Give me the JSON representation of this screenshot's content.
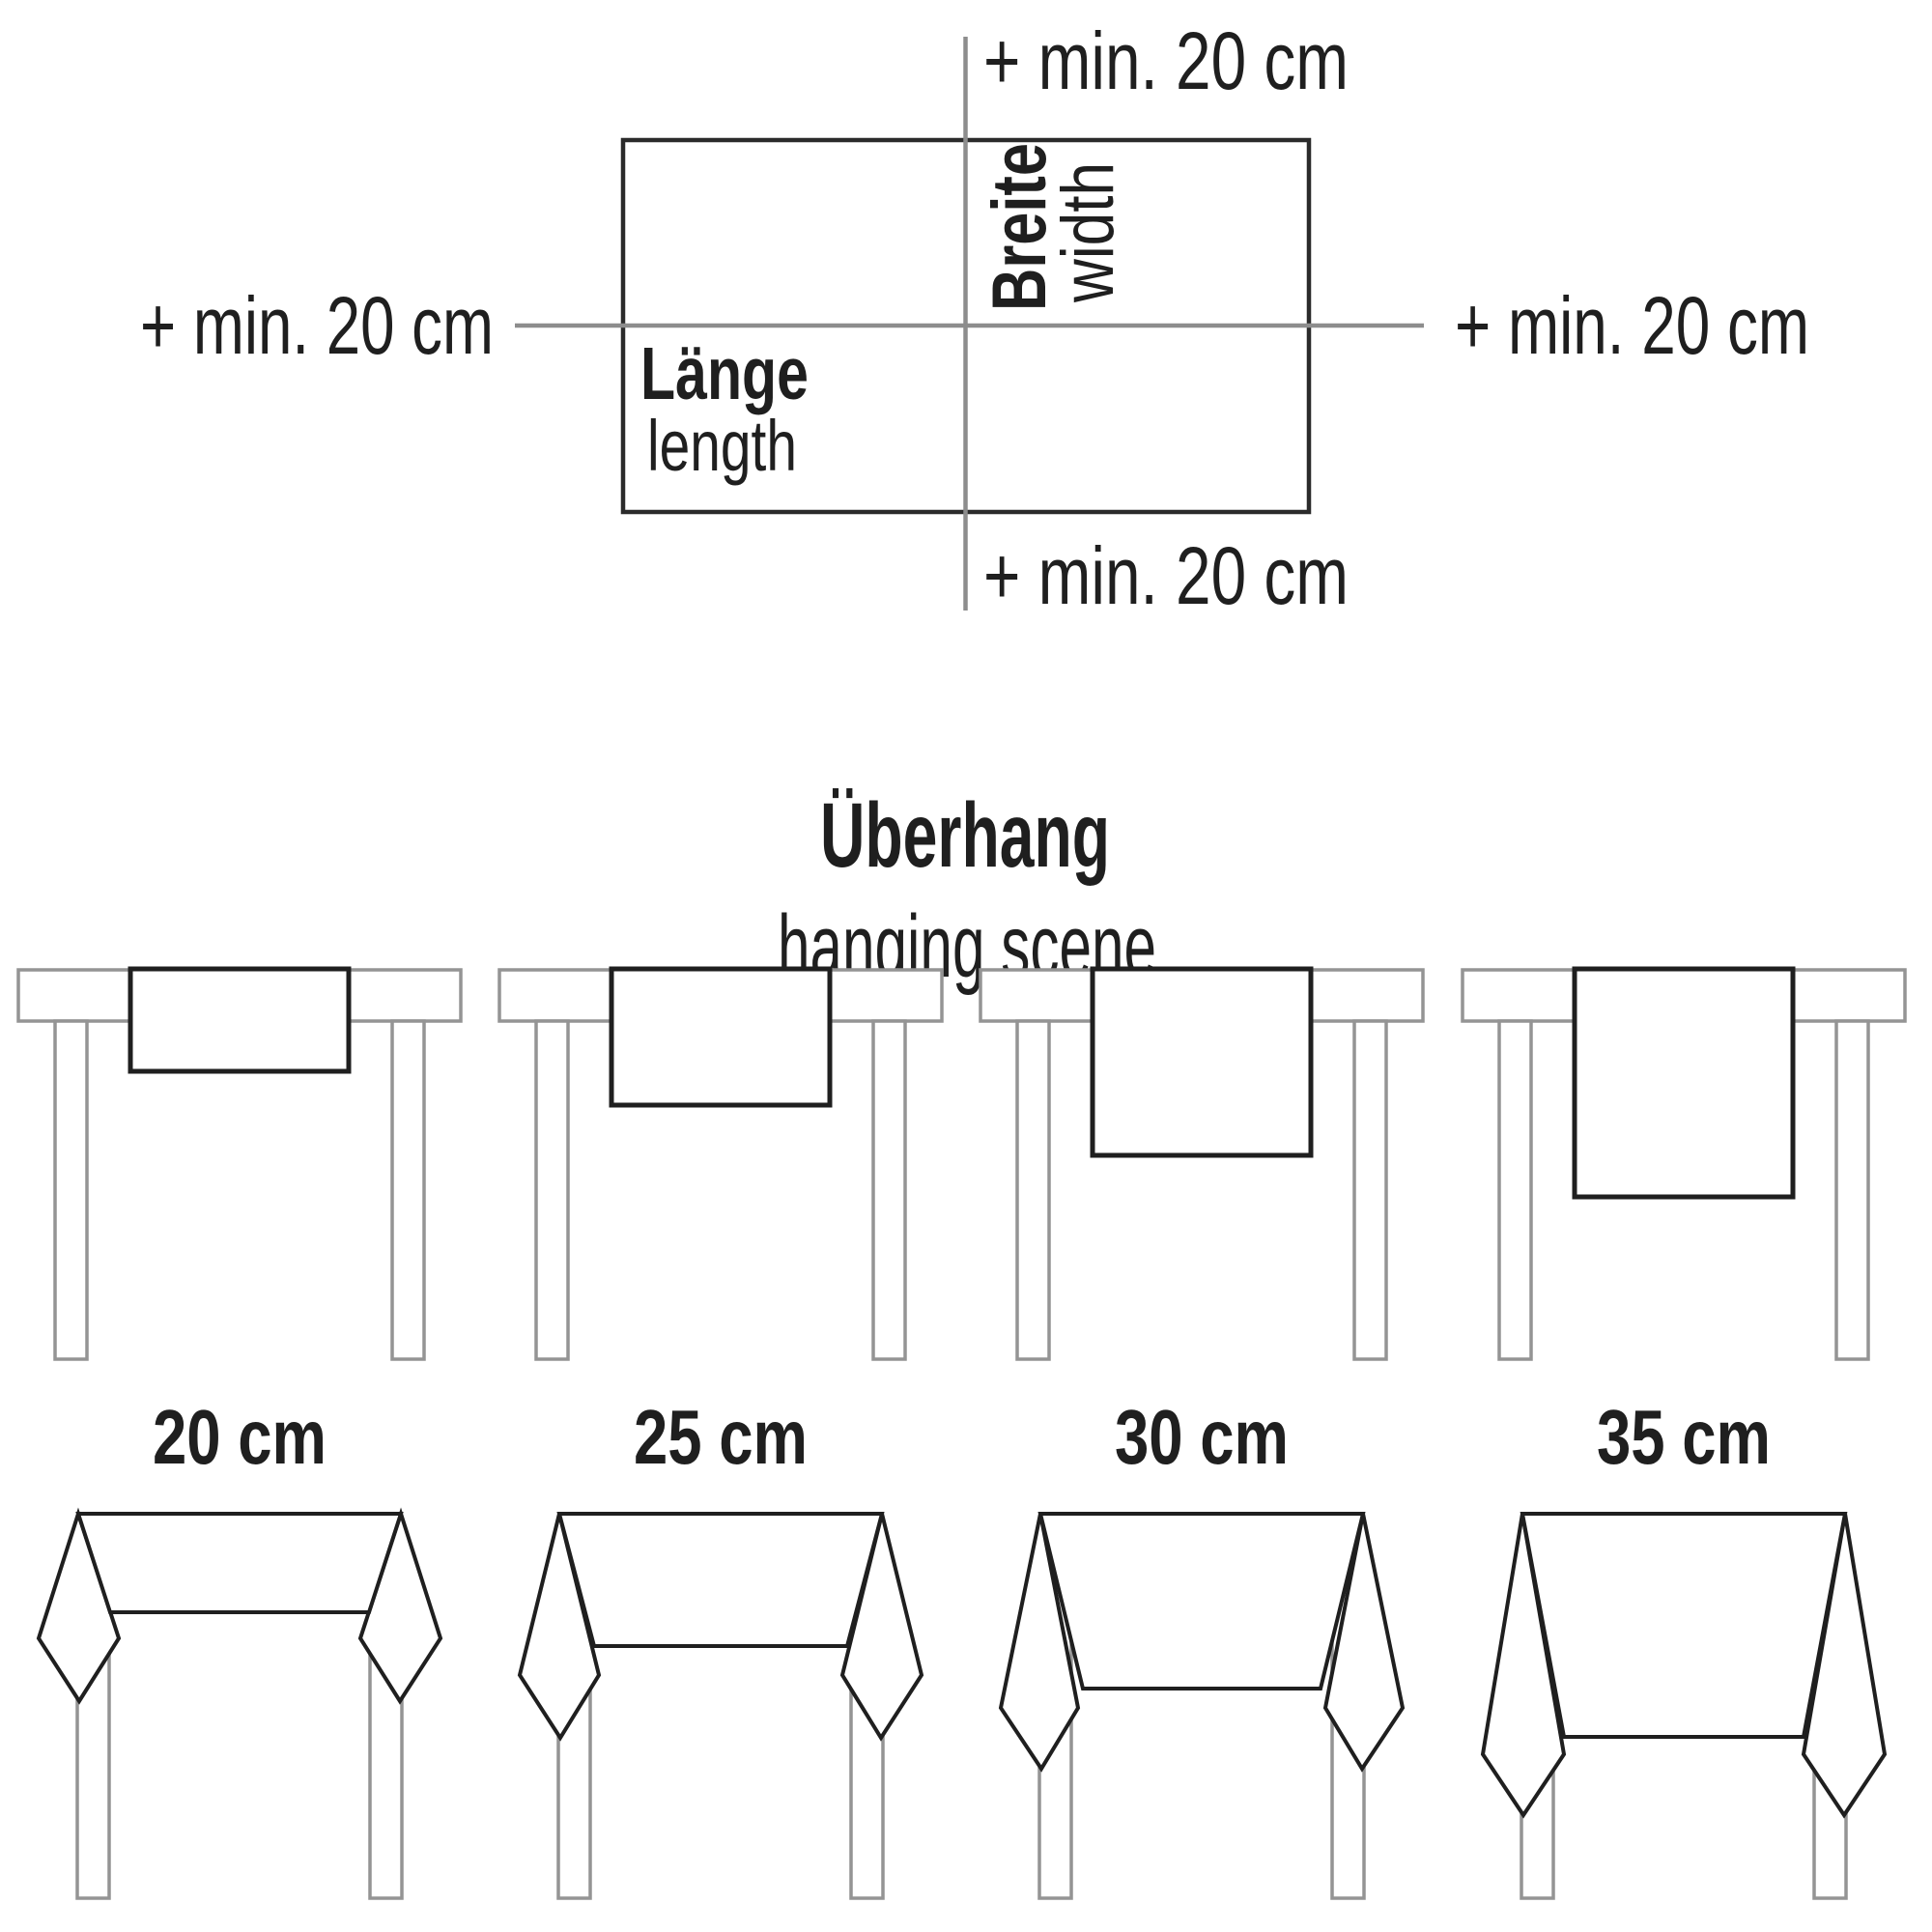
{
  "dimension_diagram": {
    "margin_label_top": "+ min. 20 cm",
    "margin_label_bottom": "+ min. 20 cm",
    "margin_label_left": "+ min. 20 cm",
    "margin_label_right": "+ min. 20 cm",
    "length_label_de": "Länge",
    "length_label_en": "length",
    "width_label_de": "Breite",
    "width_label_en": "width"
  },
  "overhang_section": {
    "title_de": "Überhang",
    "title_en": "hanging scene",
    "overhang_options": [
      {
        "label": "20 cm"
      },
      {
        "label": "25 cm"
      },
      {
        "label": "30 cm"
      },
      {
        "label": "35 cm"
      }
    ]
  },
  "colors": {
    "guide_line_gray": "#8d8d8d",
    "table_gray": "#949494",
    "ink": "#1f1f1f"
  }
}
